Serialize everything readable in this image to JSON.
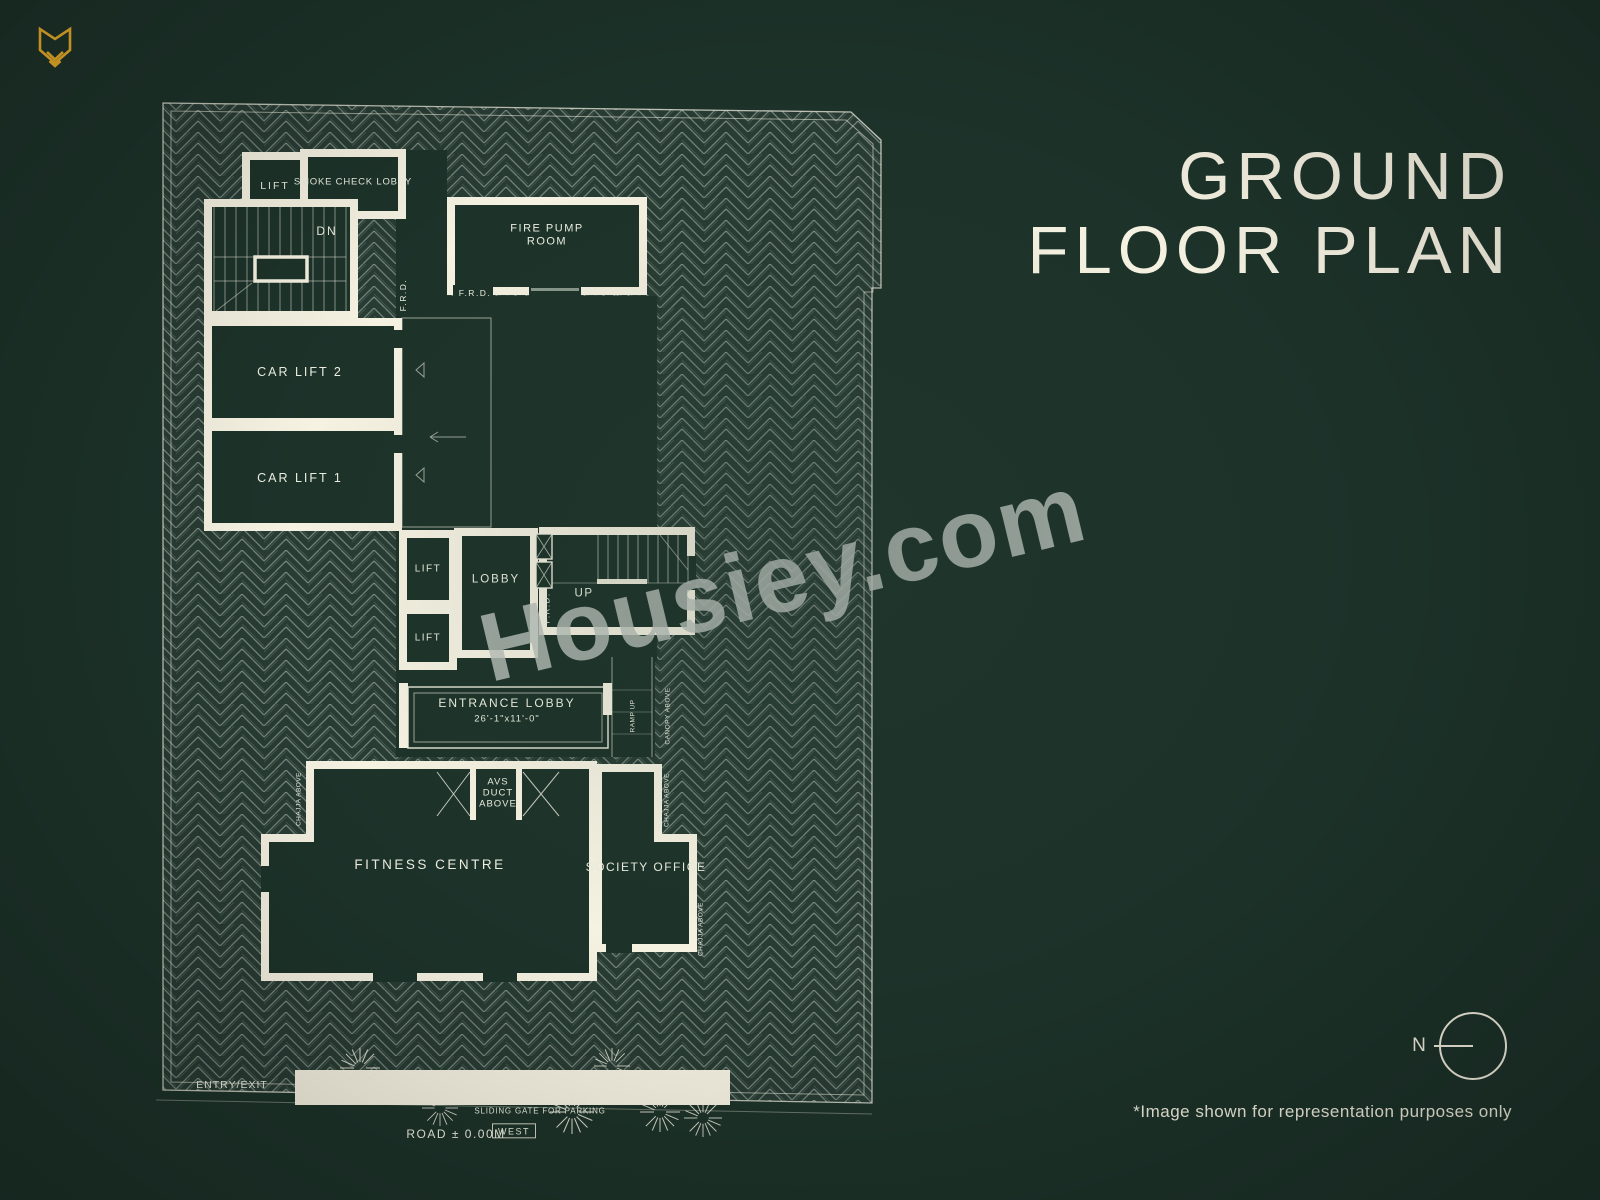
{
  "colors": {
    "background": "#1d332a",
    "line_cream": "#f6f2e2",
    "accent_gold": "#edb02b",
    "watermark_gray": "#bbc2bc"
  },
  "header": {
    "title_line1": "GROUND",
    "title_line2": "FLOOR PLAN"
  },
  "watermark": {
    "text": "Housiey.com"
  },
  "footer": {
    "disclaimer": "*Image shown for representation purposes only"
  },
  "compass": {
    "north_label": "N"
  },
  "plan": {
    "rooms": {
      "lift_top": "LIFT",
      "smoke_check_lobby": "SMOKE CHECK LOBBY",
      "stair_down": "DN",
      "fire_pump_room_line1": "FIRE PUMP",
      "fire_pump_room_line2": "ROOM",
      "car_lift_2": "CAR LIFT 2",
      "car_lift_1": "CAR LIFT 1",
      "lift_a": "LIFT",
      "lift_b": "LIFT",
      "lobby": "LOBBY",
      "stair_up": "UP",
      "entrance_lobby": "ENTRANCE LOBBY",
      "entrance_lobby_dim": "26'-1\"x11'-0\"",
      "avs_duct_line1": "AVS",
      "avs_duct_line2": "DUCT",
      "avs_duct_line3": "ABOVE",
      "fitness_centre": "FITNESS CENTRE",
      "society_office": "SOCIETY OFFICE"
    },
    "annotations": {
      "frd_corridor": "F.R.D.",
      "frd_fire_pump": "F.R.D.",
      "frd_stair": "F.R.D.",
      "ramp_up": "RAMP UP",
      "canopy_above": "CANOPY ABOVE",
      "chajja_above_left": "CHAJJA ABOVE",
      "chajja_above_mid": "CHAJJA ABOVE",
      "chajja_above_right": "CHAJJA ABOVE",
      "entry_exit": "ENTRY/EXIT",
      "sliding_gate": "SLIDING GATE FOR PARKING",
      "road_level": "ROAD ± 0.00M",
      "direction_west": "WEST"
    }
  }
}
